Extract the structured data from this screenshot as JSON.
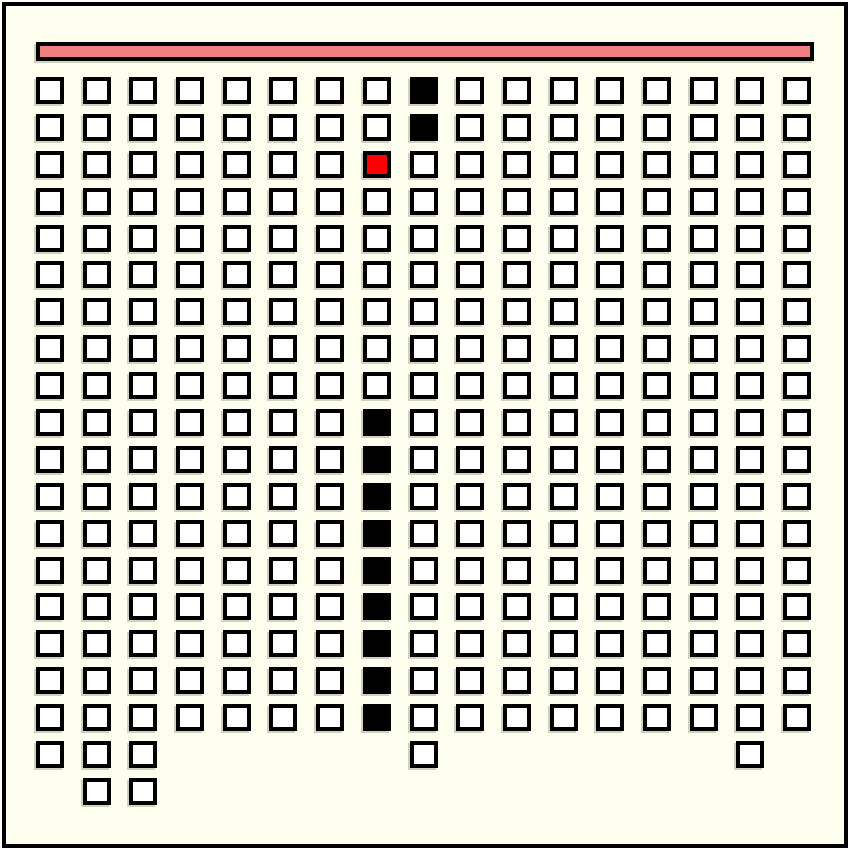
{
  "window": {
    "page_background": "#ffffff",
    "canvas_background": "#fffff0",
    "frame_border_color": "#000000"
  },
  "progress_bar": {
    "fill_color": "#f08080",
    "border_color": "#000000"
  },
  "board": {
    "columns": 17,
    "rows": 20,
    "cell_states_legend": {
      ".": "empty",
      "#": "filled-black",
      "R": "filled-red",
      " ": "absent"
    },
    "cell_colors": {
      "empty": "#ffffff",
      "filled-black": "#000000",
      "filled-red": "#ff0000",
      "border": "#000000"
    },
    "rows_map": [
      "........#........",
      "........#........",
      ".......R.........",
      ".................",
      ".................",
      ".................",
      ".................",
      ".................",
      ".................",
      ".......#.........",
      ".......#.........",
      ".......#.........",
      ".......#.........",
      ".......#.........",
      ".......#.........",
      ".......#.........",
      ".......#.........",
      ".......#.........",
      "...     .      . ",
      " ..              "
    ],
    "cell_counts": {
      "total": 313,
      "empty": 301,
      "filled_black": 11,
      "filled_red": 1
    }
  }
}
